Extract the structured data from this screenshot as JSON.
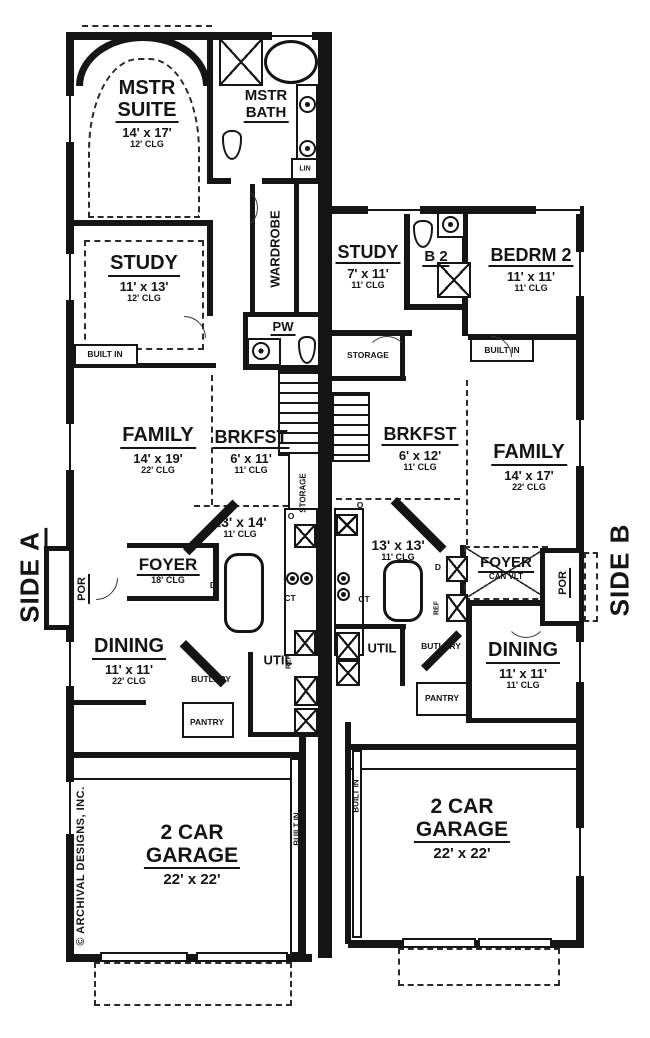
{
  "copyright": "© ARCHIVAL DESIGNS, INC.",
  "colors": {
    "ink": "#151515",
    "paper": "#ffffff"
  },
  "side_a": {
    "label": "SIDE A",
    "rooms": {
      "mstr_suite": {
        "line1": "MSTR",
        "line2": "SUITE",
        "dims": "14' x 17'",
        "clg": "12' CLG"
      },
      "mstr_bath": {
        "line1": "MSTR",
        "line2": "BATH"
      },
      "lin": "LIN",
      "wardrobe": "WARDROBE",
      "study": {
        "name": "STUDY",
        "dims": "11' x 13'",
        "clg": "12' CLG"
      },
      "pw": "PW",
      "built_in": "BUILT IN",
      "family": {
        "name": "FAMILY",
        "dims": "14' x 19'",
        "clg": "22' CLG"
      },
      "brkfst": {
        "name": "BRKFST",
        "dims": "6' x 11'",
        "clg": "11' CLG"
      },
      "storage": "STORAGE",
      "kitchen": {
        "dims": "13' x 14'",
        "clg": "11' CLG"
      },
      "oven": "O",
      "cooktop": "CT",
      "ref": "REF",
      "dishwasher": "D",
      "foyer": {
        "name": "FOYER",
        "clg": "18' CLG"
      },
      "por": "POR",
      "dining": {
        "name": "DINING",
        "dims": "11' x 11'",
        "clg": "22' CLG"
      },
      "butlery": "BUTLERY",
      "pantry": "PANTRY",
      "util": "UTIL",
      "garage": {
        "line1": "2 CAR",
        "line2": "GARAGE",
        "dims": "22' x 22'"
      },
      "garage_built_in": "BUILT IN"
    }
  },
  "side_b": {
    "label": "SIDE B",
    "rooms": {
      "study": {
        "name": "STUDY",
        "dims": "7' x 11'",
        "clg": "11' CLG"
      },
      "b2": "B 2",
      "bedrm2": {
        "name": "BEDRM 2",
        "dims": "11' x 11'",
        "clg": "11' CLG"
      },
      "storage": "STORAGE",
      "built_in": "BUILT IN",
      "brkfst": {
        "name": "BRKFST",
        "dims": "6' x 12'",
        "clg": "11' CLG"
      },
      "family": {
        "name": "FAMILY",
        "dims": "14' x 17'",
        "clg": "22' CLG"
      },
      "kitchen": {
        "dims": "13' x 13'",
        "clg": "11' CLG"
      },
      "oven": "O",
      "cooktop": "CT",
      "ref": "REF",
      "dishwasher": "D",
      "foyer": {
        "name": "FOYER",
        "clg": "CAN VLT"
      },
      "por": "POR",
      "dining": {
        "name": "DINING",
        "dims": "11' x 11'",
        "clg": "11' CLG"
      },
      "butlery": "BUTLERY",
      "pantry": "PANTRY",
      "util": "UTIL",
      "garage": {
        "line1": "2 CAR",
        "line2": "GARAGE",
        "dims": "22' x 22'"
      },
      "garage_built_in": "BUILT IN"
    }
  }
}
